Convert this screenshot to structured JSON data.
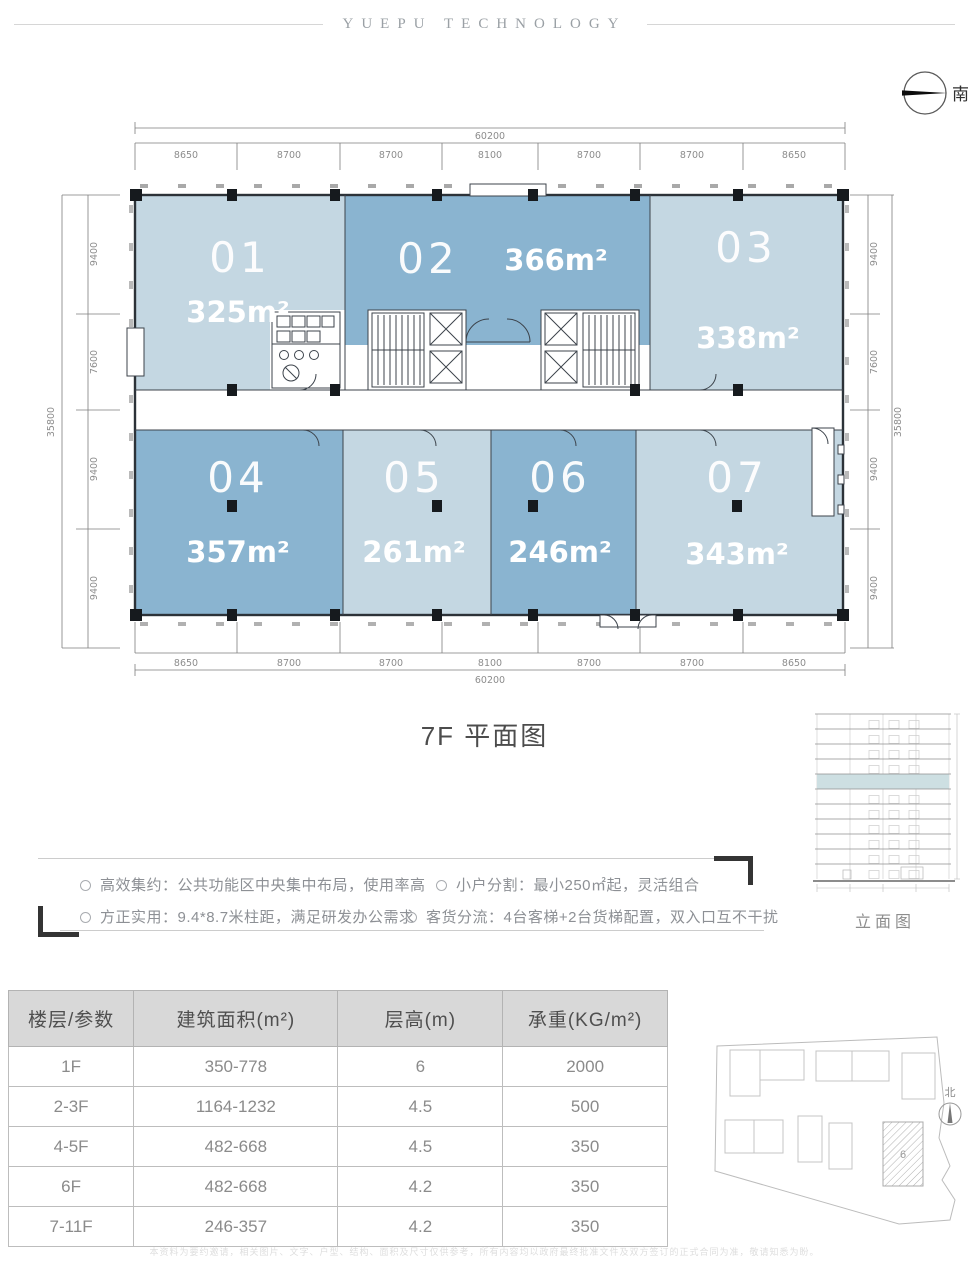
{
  "header": {
    "brand": "YUEPU TECHNOLOGY"
  },
  "compass_top": {
    "label": "南"
  },
  "plan": {
    "title": "7F 平面图",
    "colors": {
      "light": "#c4d7e2",
      "dark": "#8ab4d0"
    },
    "units": [
      {
        "id": "01",
        "area": "325m²",
        "tone": "light"
      },
      {
        "id": "02",
        "area": "366m²",
        "tone": "dark"
      },
      {
        "id": "03",
        "area": "338m²",
        "tone": "light"
      },
      {
        "id": "04",
        "area": "357m²",
        "tone": "dark"
      },
      {
        "id": "05",
        "area": "261m²",
        "tone": "light"
      },
      {
        "id": "06",
        "area": "246m²",
        "tone": "dark"
      },
      {
        "id": "07",
        "area": "343m²",
        "tone": "light"
      }
    ],
    "dims_top": {
      "total": "60200",
      "segments": [
        "8650",
        "8700",
        "8700",
        "8100",
        "8700",
        "8700",
        "8650"
      ]
    },
    "dims_bottom": {
      "total": "60200",
      "segments": [
        "8650",
        "8700",
        "8700",
        "8100",
        "8700",
        "8700",
        "8650"
      ]
    },
    "dims_left": {
      "total": "35800",
      "segments": [
        "9400",
        "7600",
        "9400",
        "9400"
      ]
    },
    "dims_right": {
      "total": "35800",
      "segments": [
        "9400",
        "7600",
        "9400",
        "9400"
      ]
    }
  },
  "elevation": {
    "caption": "立面图"
  },
  "features": [
    {
      "text": "高效集约：公共功能区中央集中布局，使用率高"
    },
    {
      "text": "小户分割：最小250㎡起，灵活组合"
    },
    {
      "text": "方正实用：9.4*8.7米柱距，满足研发办公需求"
    },
    {
      "text": "客货分流：4台客梯+2台货梯配置，双入口互不干扰"
    }
  ],
  "spec_table": {
    "headers": [
      "楼层/参数",
      "建筑面积(m²)",
      "层高(m)",
      "承重(KG/m²)"
    ],
    "rows": [
      [
        "1F",
        "350-778",
        "6",
        "2000"
      ],
      [
        "2-3F",
        "1164-1232",
        "4.5",
        "500"
      ],
      [
        "4-5F",
        "482-668",
        "4.5",
        "350"
      ],
      [
        "6F",
        "482-668",
        "4.2",
        "350"
      ],
      [
        "7-11F",
        "246-357",
        "4.2",
        "350"
      ]
    ]
  },
  "site_plan": {
    "north_label": "北",
    "highlight_label": "6"
  },
  "footer": {
    "disclaimer": "本资料为要约邀请，相关图片、文字、户型、结构、面积及尺寸仅供参考，所有内容均以政府最终批准文件及双方签订的正式合同为准，敬请知悉为盼。"
  }
}
